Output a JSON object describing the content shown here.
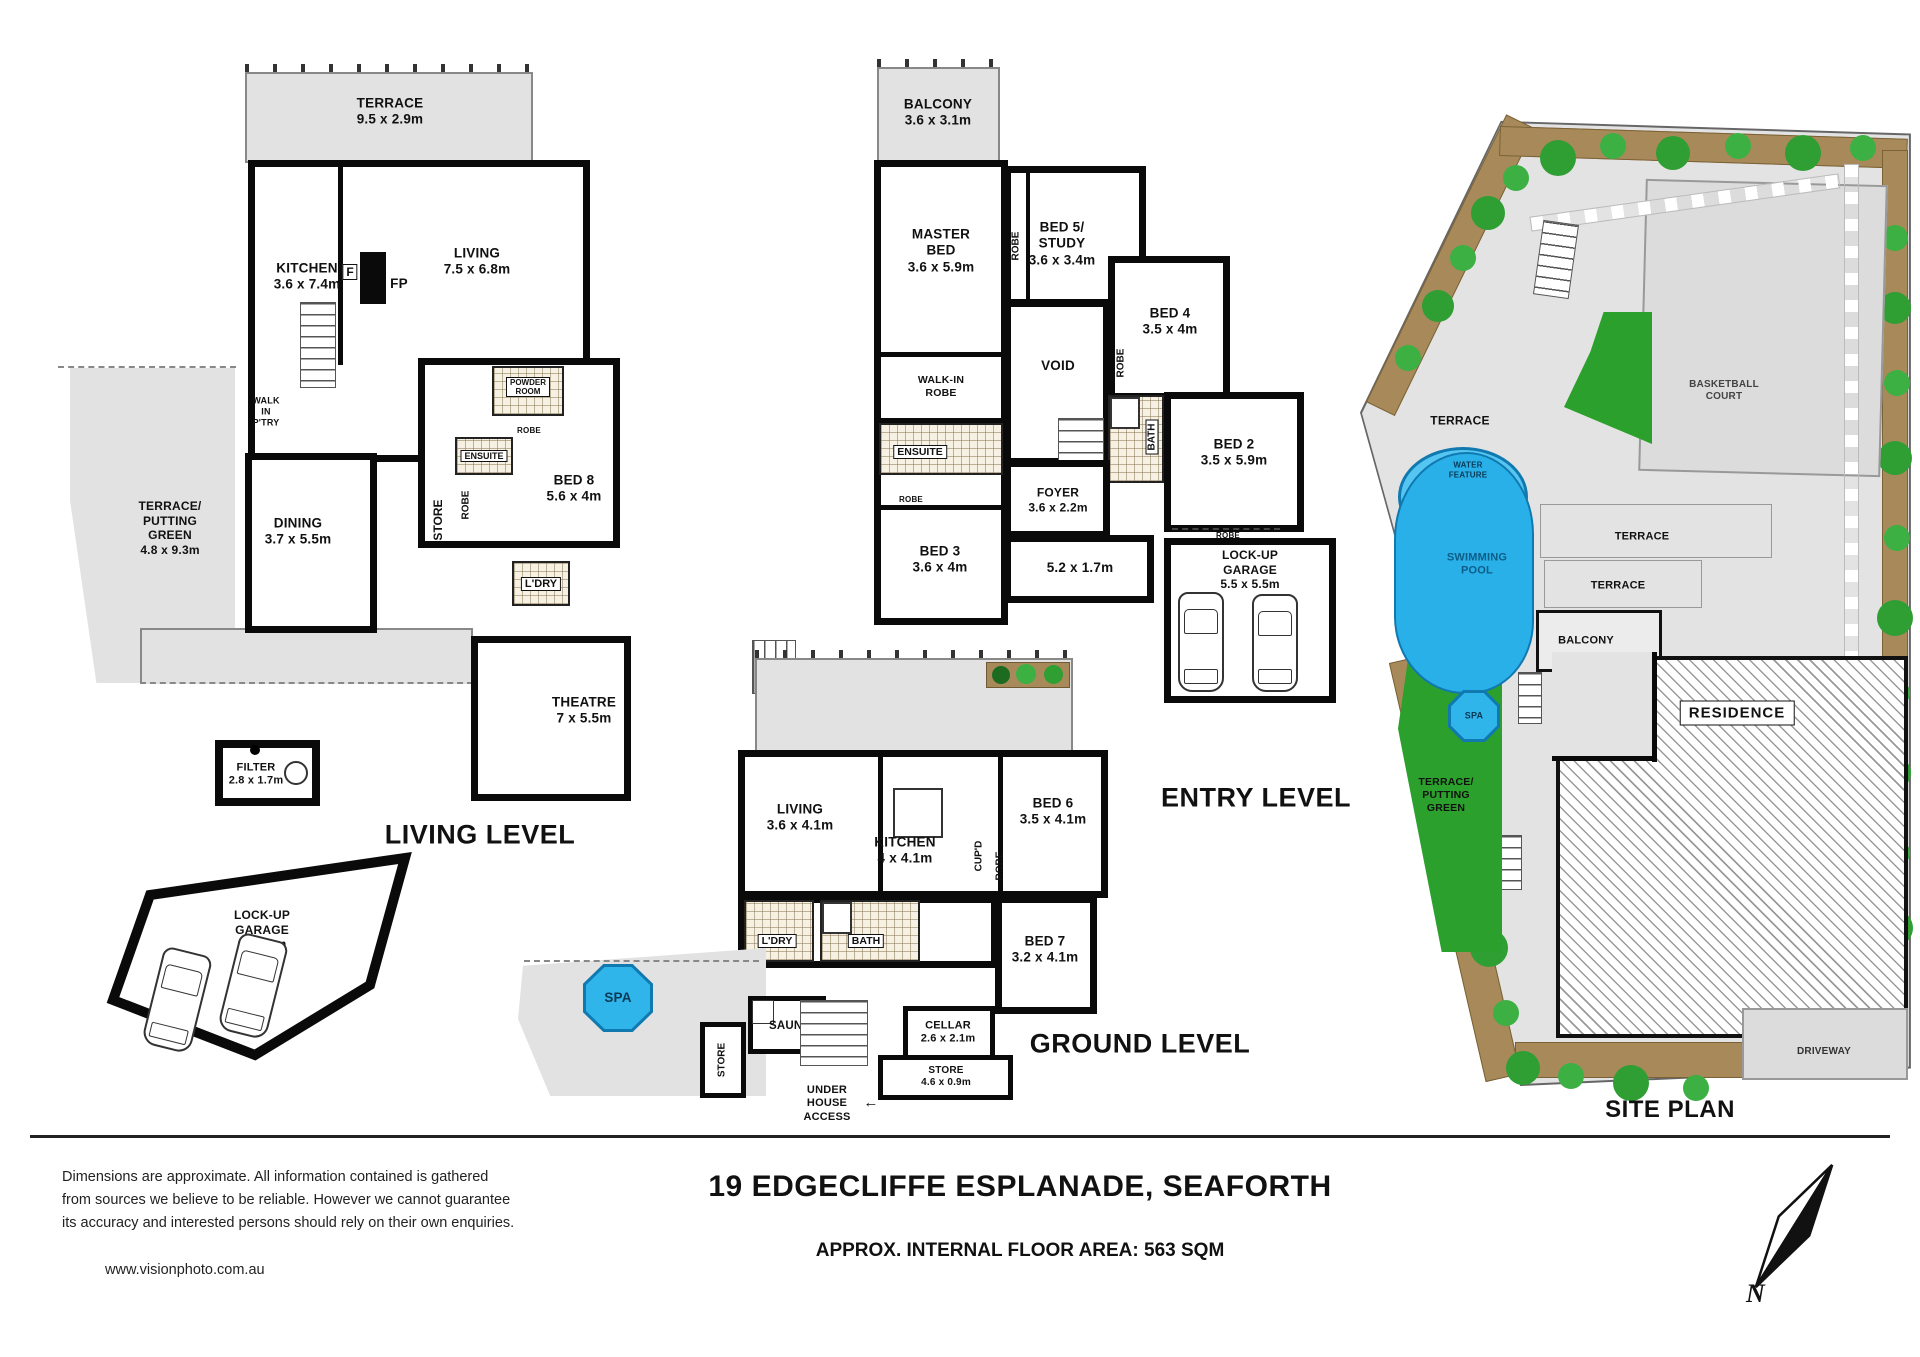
{
  "footer": {
    "disclaimer_lines": [
      "Dimensions  are  approximate.  All  information  contained  is  gathered",
      "from sources we believe to be reliable.  However we cannot guarantee",
      "its accuracy and interested persons should rely on their own enquiries."
    ],
    "website": "www.visionphoto.com.au",
    "address": "19 EDGECLIFFE ESPLANADE, SEAFORTH",
    "floor_area_note": "APPROX. INTERNAL FLOOR AREA: 563 SQM",
    "compass_north": "N"
  },
  "living_level": {
    "title": "LIVING LEVEL",
    "terrace": {
      "name": "TERRACE",
      "dims": "9.5 x 2.9m"
    },
    "kitchen": {
      "name": "KITCHEN",
      "dims": "3.6 x 7.4m"
    },
    "fridge": "F",
    "fireplace": "FP",
    "living": {
      "name": "LIVING",
      "dims": "7.5 x 6.8m"
    },
    "walk_in_pantry": {
      "lines": [
        "WALK",
        "IN",
        "P'TRY"
      ]
    },
    "powder_room": {
      "lines": [
        "POWDER",
        "ROOM"
      ]
    },
    "putting_green": {
      "lines": [
        "TERRACE/",
        "PUTTING",
        "GREEN"
      ],
      "dims": "4.8 x 9.3m"
    },
    "dining": {
      "name": "DINING",
      "dims": "3.7 x 5.5m"
    },
    "store": "STORE",
    "ensuite": "ENSUITE",
    "robe_a": "ROBE",
    "robe_b": "ROBE",
    "bed8": {
      "name": "BED 8",
      "dims": "5.6 x 4m"
    },
    "laundry": "L'DRY",
    "theatre": {
      "name": "THEATRE",
      "dims": "7 x 5.5m"
    },
    "filter": {
      "name": "FILTER",
      "dims": "2.8 x 1.7m"
    },
    "garage": {
      "lines": [
        "LOCK-UP",
        "GARAGE"
      ],
      "dims": "6.3 x 6m"
    }
  },
  "entry_level": {
    "title": "ENTRY LEVEL",
    "balcony": {
      "name": "BALCONY",
      "dims": "3.6 x 3.1m"
    },
    "master_bed": {
      "lines": [
        "MASTER",
        "BED"
      ],
      "dims": "3.6 x 5.9m"
    },
    "bed5_study": {
      "lines": [
        "BED 5/",
        "STUDY"
      ],
      "dims": "3.6 x 3.4m"
    },
    "bed4": {
      "name": "BED 4",
      "dims": "3.5 x 4m"
    },
    "bed2": {
      "name": "BED 2",
      "dims": "3.5 x 5.9m"
    },
    "bed3": {
      "name": "BED 3",
      "dims": "3.6 x 4m"
    },
    "void": "VOID",
    "walk_in_robe": {
      "lines": [
        "WALK-IN",
        "ROBE"
      ]
    },
    "ensuite": "ENSUITE",
    "bath": "BATH",
    "foyer": {
      "name": "FOYER",
      "dims": "3.6 x 2.2m"
    },
    "hall_dims": "5.2 x 1.7m",
    "robe_a": "ROBE",
    "robe_b": "ROBE",
    "robe_c": "ROBE",
    "robe_d": "ROBE",
    "garage": {
      "lines": [
        "LOCK-UP",
        "GARAGE"
      ],
      "dims": "5.5 x 5.5m"
    }
  },
  "ground_level": {
    "title": "GROUND LEVEL",
    "terrace": "TERRACE",
    "living": {
      "name": "LIVING",
      "dims": "3.6 x 4.1m"
    },
    "kitchen": {
      "name": "KITCHEN",
      "dims": "4 x 4.1m"
    },
    "bed6": {
      "name": "BED 6",
      "dims": "3.5 x 4.1m"
    },
    "bed7": {
      "name": "BED 7",
      "dims": "3.2 x 4.1m"
    },
    "robe": "ROBE",
    "cupboard": "CUP'D",
    "laundry": "L'DRY",
    "bath": "BATH",
    "spa": "SPA",
    "store_a": "STORE",
    "sauna": "SAUNA",
    "cellar": {
      "name": "CELLAR",
      "dims": "2.6 x 2.1m"
    },
    "store_b": {
      "name": "STORE",
      "dims": "4.6 x 0.9m"
    },
    "under_house": {
      "lines": [
        "UNDER",
        "HOUSE",
        "ACCESS"
      ]
    }
  },
  "site_plan": {
    "title": "SITE PLAN",
    "terrace_upper": "TERRACE",
    "basketball_court": {
      "lines": [
        "BASKETBALL",
        "COURT"
      ]
    },
    "water_feature": {
      "lines": [
        "WATER",
        "FEATURE"
      ]
    },
    "swimming_pool": {
      "lines": [
        "SWIMMING",
        "POOL"
      ]
    },
    "terrace_mid": "TERRACE",
    "terrace_lower": "TERRACE",
    "balcony": "BALCONY",
    "spa": "SPA",
    "putting_green": {
      "lines": [
        "TERRACE/",
        "PUTTING",
        "GREEN"
      ]
    },
    "residence": "RESIDENCE",
    "driveway": "DRIVEWAY"
  },
  "colors": {
    "wall": "#0a0a0a",
    "outdoor_gray": "#e2e2e2",
    "water_blue": "#29b0e8",
    "water_blue_dark": "#1079b0",
    "grass_green": "#2ca02c",
    "garden_brown": "#a88a5a",
    "tree_green": "#3cb043"
  }
}
